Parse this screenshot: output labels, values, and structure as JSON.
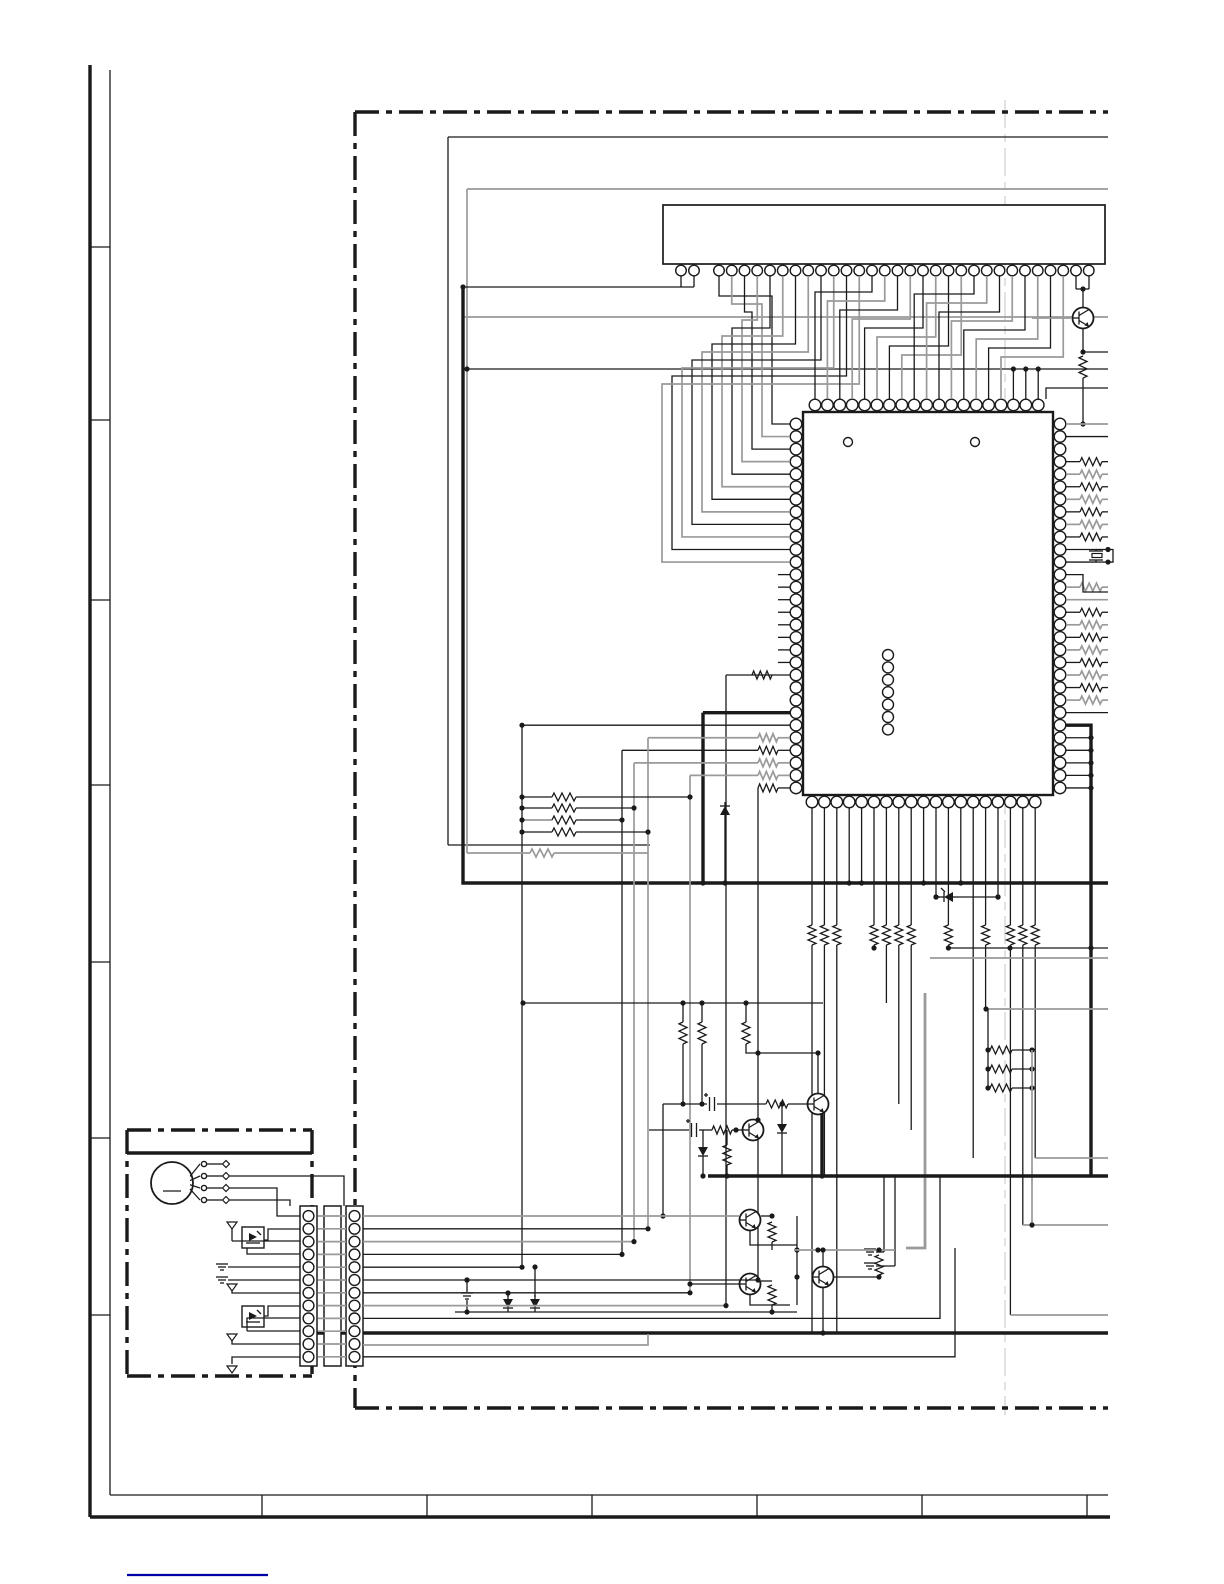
{
  "page": {
    "type": "service-manual schematic page",
    "description": "Left half of a printed circuit schematic page: page frame with zone tick marks, dash-dot PWB boundary, a 32-pin flat connector on top fanning out into a large quad-flat-pack IC, resistor arrays on the IC right-side pins, a crystal resonator, transistor/diode clusters below the IC, and a small motor unit module (DC motor, photo-interrupters) at lower left joined through two 12-pin board-to-board connector strips. No text labels are printed on this half of the scan.",
    "footer_link_label": ""
  },
  "components": {
    "top_connector": {
      "name": "flat-cable-connector",
      "pins": 32
    },
    "main_ic": {
      "name": "main-ic-qfp",
      "pins_top": 19,
      "pins_bottom": 19,
      "pins_left": 30,
      "pins_right": 30,
      "index_marks": 2,
      "via_column_circles": 7
    },
    "crystal": 1,
    "transistors": 7,
    "photo_interrupters": 2,
    "dc_motor": {
      "terminals": 4
    },
    "board_connector_strips": {
      "strips": 2,
      "pins_per_strip": 12
    },
    "frame_zone_ticks": 7,
    "footer_cells": 6
  },
  "colors": {
    "line": "#1a1a1a",
    "bus_gray": "#9a9a9a",
    "fold_line": "#c9c9c9",
    "link_blue": "#0000a8",
    "background": "#ffffff"
  }
}
